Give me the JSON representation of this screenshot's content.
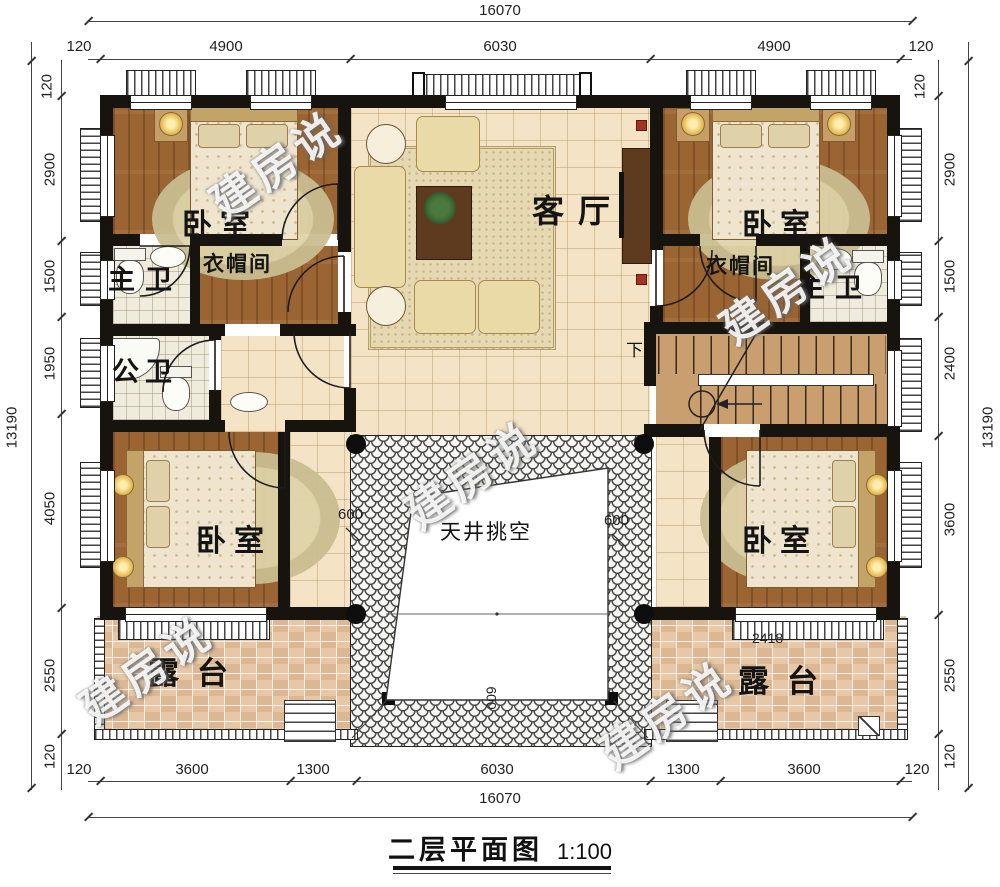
{
  "title": {
    "text": "二层平面图",
    "scale": "1:100"
  },
  "watermark": {
    "text": "建房说"
  },
  "rooms": {
    "bedroom_tl": "卧室",
    "bedroom_tr": "卧室",
    "bedroom_bl": "卧室",
    "bedroom_br": "卧室",
    "living": "客厅",
    "cloak_l": "衣帽间",
    "cloak_r": "衣帽间",
    "mbath_l": "主卫",
    "mbath_r": "主卫",
    "pbath": "公卫",
    "terrace_l": "露台",
    "terrace_r": "露台",
    "atrium": "天井挑空",
    "stair_down": "下"
  },
  "annotations": {
    "atrium_left": "600",
    "atrium_right": "600",
    "canopy": "600",
    "railing_right": "2418"
  },
  "dims": {
    "top": {
      "total": "16070",
      "segs": [
        "120",
        "4900",
        "6030",
        "4900",
        "120"
      ]
    },
    "left": {
      "top120": "120",
      "segs": [
        "2900",
        "1500",
        "1950",
        "4050",
        "2550"
      ],
      "bottom120": "120",
      "bottom120b": "120",
      "total": "13190"
    },
    "right": {
      "top120": "120",
      "segs": [
        "2900",
        "1500",
        "2400",
        "3600",
        "2550"
      ],
      "bottom120": "120",
      "total": "13190"
    },
    "bottom": {
      "segs": [
        "120",
        "3600",
        "1300",
        "6030",
        "1300",
        "3600",
        "120"
      ],
      "total": "16070"
    }
  }
}
